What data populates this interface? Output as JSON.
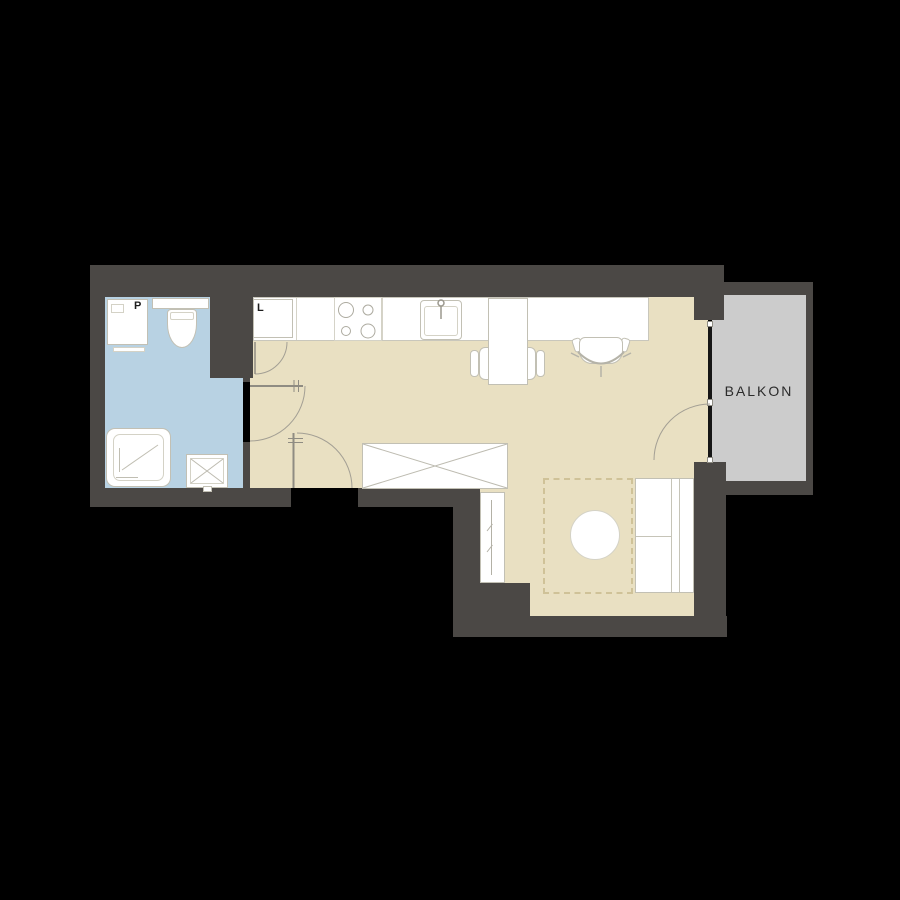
{
  "plan": {
    "labels": {
      "washing_machine": "P",
      "fridge": "L",
      "balcony": "BALKON"
    },
    "colors": {
      "background": "#000000",
      "wall": "#4b4845",
      "bathroom_floor": "#b8d2e3",
      "room_floor": "#e9e0c2",
      "balcony_floor": "#cccccc",
      "window": "#161616",
      "line": "#a6a399",
      "dash": "#cfc298"
    },
    "icons": [
      "washing-machine-icon",
      "toilet-icon",
      "shower-icon",
      "bathroom-sink-icon",
      "fridge-icon",
      "stove-icon",
      "kitchen-sink-icon",
      "counter-icon",
      "desk-icon",
      "desk-chair-icon",
      "office-chair-icon",
      "wardrobe-icon",
      "tv-board-icon",
      "bed-icon",
      "round-table-icon",
      "rug-icon",
      "door-swing-icon",
      "balcony-door-icon"
    ]
  }
}
